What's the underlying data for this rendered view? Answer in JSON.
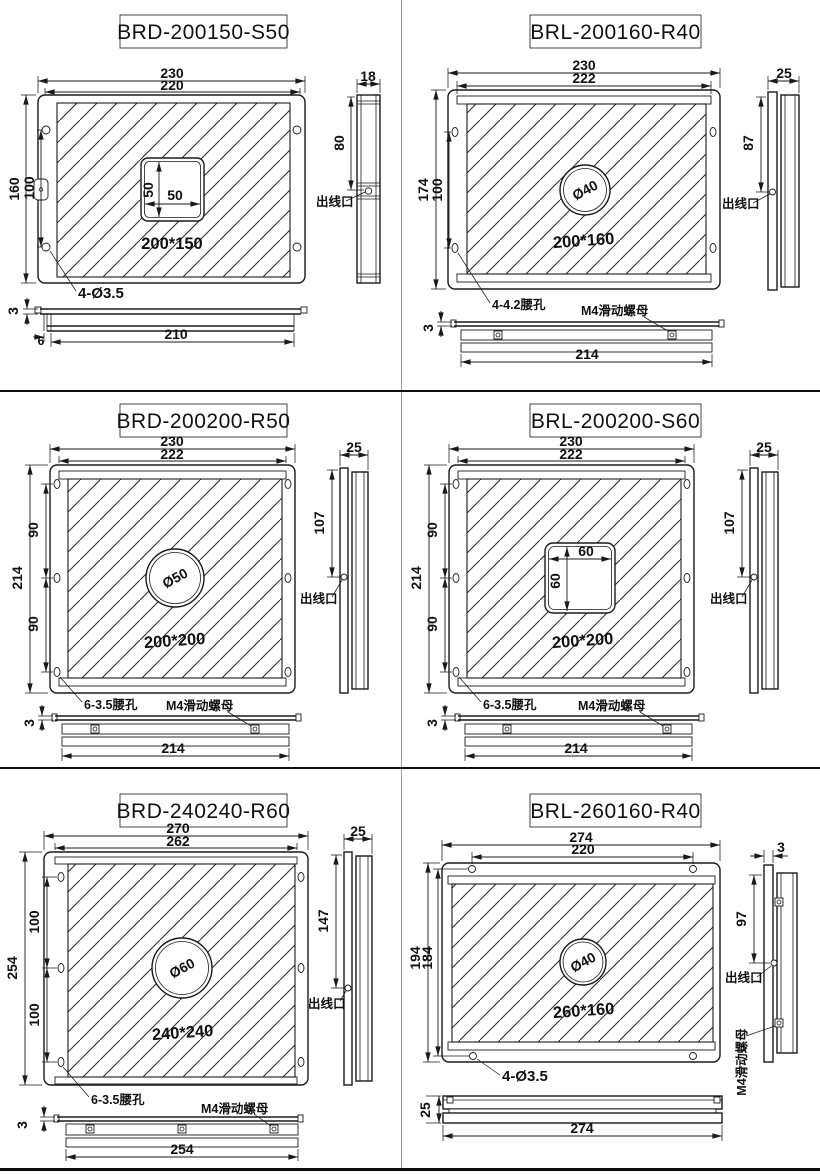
{
  "page": {
    "background": "#ffffff",
    "line_color": "#1a1a1a",
    "divider_color": "#0d0d0d",
    "vertical_divider_color": "#9a9a9a"
  },
  "shared": {
    "outlet_label": "出线口",
    "m4_nut_label": "M4滑动螺母"
  },
  "panels": [
    {
      "title": "BRD-200150-S50",
      "front": {
        "dim_outer_w": "230",
        "dim_inner_w": "220",
        "dim_outer_h": "160",
        "dim_inner_h": "100",
        "center_dim_v": "50",
        "center_dim_h": "50",
        "area_label": "200*150",
        "hole_callout": "4-Ø3.5"
      },
      "side": {
        "dim_w": "18",
        "dim_h": "80"
      },
      "bottom": {
        "dim_t": "3",
        "dim_lip": "6",
        "dim_w": "210"
      }
    },
    {
      "title": "BRL-200160-R40",
      "front": {
        "dim_outer_w": "230",
        "dim_inner_w": "222",
        "dim_outer_h": "174",
        "dim_inner_h": "100",
        "center_label": "Ø40",
        "area_label": "200*160",
        "hole_callout": "4-4.2腰孔"
      },
      "side": {
        "dim_w": "25",
        "dim_h": "87"
      },
      "bottom": {
        "dim_t": "3",
        "dim_w": "214"
      }
    },
    {
      "title": "BRD-200200-R50",
      "front": {
        "dim_outer_w": "230",
        "dim_inner_w": "222",
        "dim_outer_h": "214",
        "dim_seg_top": "90",
        "dim_seg_bottom": "90",
        "center_label": "Ø50",
        "area_label": "200*200",
        "hole_callout": "6-3.5腰孔"
      },
      "side": {
        "dim_w": "25",
        "dim_h": "107"
      },
      "bottom": {
        "dim_t": "3",
        "dim_w": "214"
      }
    },
    {
      "title": "BRL-200200-S60",
      "front": {
        "dim_outer_w": "230",
        "dim_inner_w": "222",
        "dim_outer_h": "214",
        "dim_seg_top": "90",
        "dim_seg_bottom": "90",
        "center_dim_h": "60",
        "center_dim_v": "60",
        "area_label": "200*200",
        "hole_callout": "6-3.5腰孔"
      },
      "side": {
        "dim_w": "25",
        "dim_h": "107"
      },
      "bottom": {
        "dim_t": "3",
        "dim_w": "214"
      }
    },
    {
      "title": "BRD-240240-R60",
      "front": {
        "dim_outer_w": "270",
        "dim_inner_w": "262",
        "dim_outer_h": "254",
        "dim_seg_top": "100",
        "dim_seg_bottom": "100",
        "center_label": "Ø60",
        "area_label": "240*240",
        "hole_callout": "6-3.5腰孔"
      },
      "side": {
        "dim_w": "25",
        "dim_h": "147"
      },
      "bottom": {
        "dim_t": "3",
        "dim_w": "254"
      }
    },
    {
      "title": "BRL-260160-R40",
      "front": {
        "dim_outer_w": "274",
        "dim_inner_w": "220",
        "dim_outer_h": "194",
        "dim_inner_h": "184",
        "center_label": "Ø40",
        "area_label": "260*160",
        "hole_callout": "4-Ø3.5"
      },
      "side": {
        "dim_t": "3",
        "dim_h": "97"
      },
      "bottom": {
        "dim_t": "25",
        "dim_w": "274"
      }
    }
  ]
}
